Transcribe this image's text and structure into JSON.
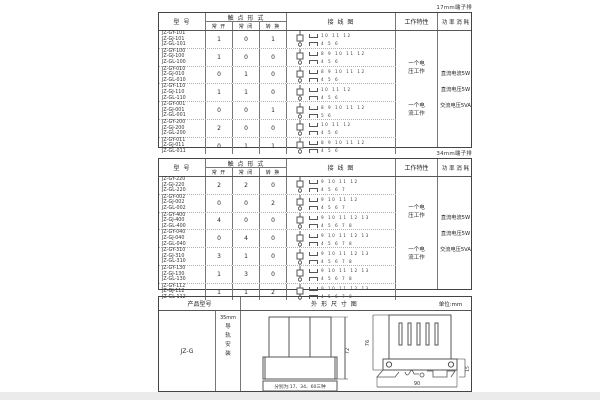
{
  "page": {
    "label_table1": "17mm端子排",
    "label_table2": "34mm端子排"
  },
  "headers": {
    "model": "型 号",
    "contact_form": "触 点 形 式",
    "normally_open": "常 开",
    "normally_closed": "常 闭",
    "changeover": "转 换",
    "wiring_diagram": "接 线 图",
    "work_characteristic": "工作特性",
    "power_consumption": "功 率 消 耗"
  },
  "work_characteristics": [
    "一个电\n压工作",
    "一个电\n流工作"
  ],
  "power_consumption": [
    "直流电流5W",
    "直流电压5W",
    "交流电压5VA"
  ],
  "table1": {
    "rows": [
      {
        "models": "JZ-GY-101\nJZ-GJ-101\nJZ-GL-101",
        "no": "1",
        "nc": "0",
        "co": "1",
        "top_terminals": "10 11 12",
        "bottom_terminals": "4 5 6"
      },
      {
        "models": "JZ-GY-100\nJZ-GJ-100\nJZ-GL-100",
        "no": "1",
        "nc": "0",
        "co": "0",
        "top_terminals": "8 9 10 11 12",
        "bottom_terminals": "4 5 6"
      },
      {
        "models": "JZ-GY-010\nJZ-GJ-010\nJZ-GL-010",
        "no": "0",
        "nc": "1",
        "co": "0",
        "top_terminals": "8 9 10 11 12",
        "bottom_terminals": "4 5 6"
      },
      {
        "models": "JZ-GY-110\nJZ-GJ-110\nJZ-GL-110",
        "no": "1",
        "nc": "1",
        "co": "0",
        "top_terminals": "10 11 12",
        "bottom_terminals": "4 5 6"
      },
      {
        "models": "JZ-GY-001\nJZ-GJ-001\nJZ-GL-001",
        "no": "0",
        "nc": "0",
        "co": "1",
        "top_terminals": "8 9 10 11 12",
        "bottom_terminals": "5 6"
      },
      {
        "models": "JZ-GY-200\nJZ-GJ-200\nJZ-GL-200",
        "no": "2",
        "nc": "0",
        "co": "0",
        "top_terminals": "10 11 12",
        "bottom_terminals": "4 5 6"
      },
      {
        "models": "JZ-GY-011\nJZ-GJ-011\nJZ-GL-011",
        "no": "0",
        "nc": "1",
        "co": "1",
        "top_terminals": "8 9 10 11 12",
        "bottom_terminals": "4 5 6"
      }
    ]
  },
  "table2": {
    "rows": [
      {
        "models": "JZ-GY-220\nJZ-GJ-220\nJZ-GL-220",
        "no": "2",
        "nc": "2",
        "co": "0",
        "top_terminals": "9 10 11 12",
        "bottom_terminals": "4 5 6 7"
      },
      {
        "models": "JZ-GY-002\nJZ-GJ-002\nJZ-GL-002",
        "no": "0",
        "nc": "0",
        "co": "2",
        "top_terminals": "9 10 11 12",
        "bottom_terminals": "4 5 6 7"
      },
      {
        "models": "JZ-GY-400\nJZ-GJ-400\nJZ-GL-400",
        "no": "4",
        "nc": "0",
        "co": "0",
        "top_terminals": "9 10 11 12 13",
        "bottom_terminals": "4 5 6 7 8"
      },
      {
        "models": "JZ-GY-040\nJZ-GJ-040\nJZ-GL-040",
        "no": "0",
        "nc": "4",
        "co": "0",
        "top_terminals": "9 10 11 12 13",
        "bottom_terminals": "4 5 6 7 8"
      },
      {
        "models": "JZ-GY-310\nJZ-GJ-310\nJZ-GL-310",
        "no": "3",
        "nc": "1",
        "co": "0",
        "top_terminals": "9 10 11 12 13",
        "bottom_terminals": "4 5 6 7 8"
      },
      {
        "models": "JZ-GY-130\nJZ-GJ-130\nJZ-GL-130",
        "no": "1",
        "nc": "3",
        "co": "0",
        "top_terminals": "9 10 11 12 13",
        "bottom_terminals": "4 5 6 7 8"
      },
      {
        "models": "JZ-GY-112\nJZ-GJ-112\nJZ-GL-112",
        "no": "1",
        "nc": "1",
        "co": "2",
        "top_terminals": "9 10 11 12 13",
        "bottom_terminals": "4 5 6 7 8"
      }
    ]
  },
  "table3": {
    "header_product_model": "产品型号",
    "header_outline": "外 形 尺 寸 图",
    "unit": "单位:mm",
    "product_model": "JZ-G",
    "rail_width": "35mm",
    "rail_mount": "导\n轨\n安\n装",
    "front_note": "分别为:17、34、60三种",
    "dim_front_height": "72",
    "dim_side_height": "76",
    "dim_side_width": "90",
    "dim_rail": "15"
  }
}
